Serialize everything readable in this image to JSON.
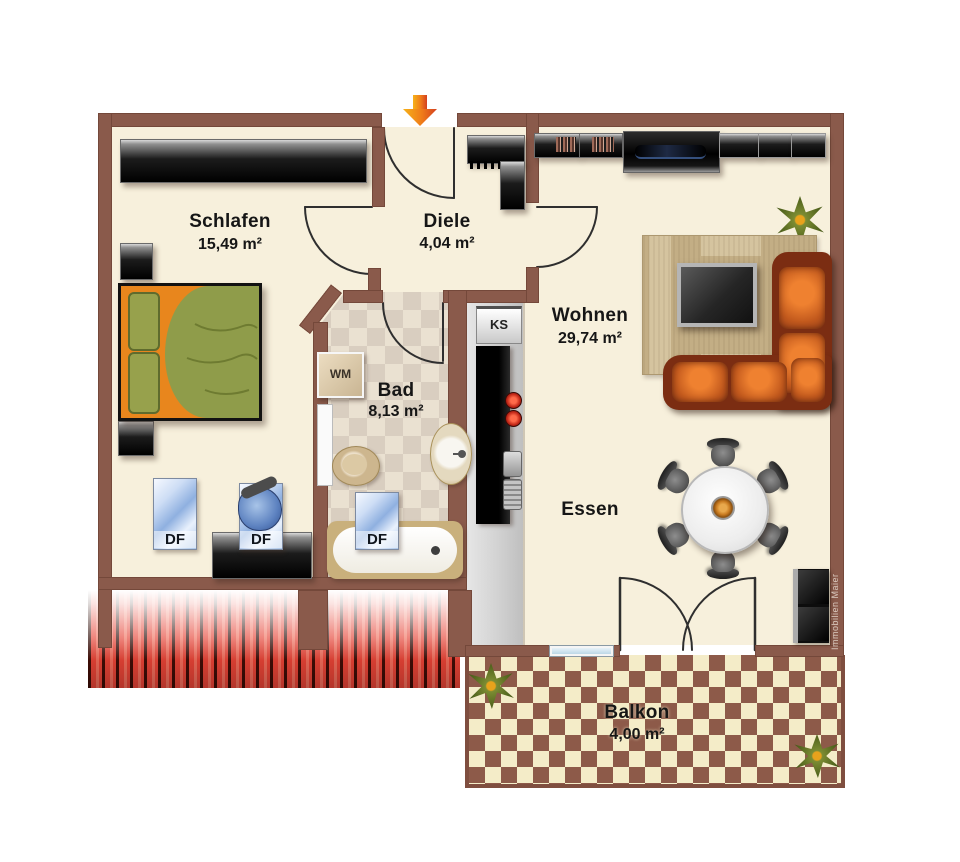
{
  "rooms": {
    "schlafen": {
      "name": "Schlafen",
      "area": "15,49 m²"
    },
    "diele": {
      "name": "Diele",
      "area": "4,04 m²"
    },
    "bad": {
      "name": "Bad",
      "area": "8,13 m²"
    },
    "wohnen": {
      "name": "Wohnen",
      "area": "29,74 m²"
    },
    "essen": {
      "name": "Essen"
    },
    "balkon": {
      "name": "Balkon",
      "area": "4,00 m²"
    }
  },
  "labels": {
    "washing_machine": "WM",
    "fridge": "KS",
    "roof_window": "DF"
  },
  "watermark": "Immobilien Maier",
  "colors": {
    "wall": "#8a5a4b",
    "floor": "#f7f0dc",
    "bath_tile_light": "#eae1d1",
    "bath_tile_dark": "#d9cec0",
    "balcony_tile_light": "#f4ecc8",
    "balcony_tile_dark": "#8d5a49",
    "roof_stripe_red": "#e6473a",
    "kitchen_strip_gray": "#d9d9d9",
    "sofa_body": "#7b2d12",
    "sofa_cushion": "#c2591d",
    "bed_frame_orange": "#e8861d",
    "bed_blanket_green": "#8f9c4a",
    "roof_window_blue": "#8fb0e0",
    "entry_arrow_orange": "#ef7c1a"
  }
}
